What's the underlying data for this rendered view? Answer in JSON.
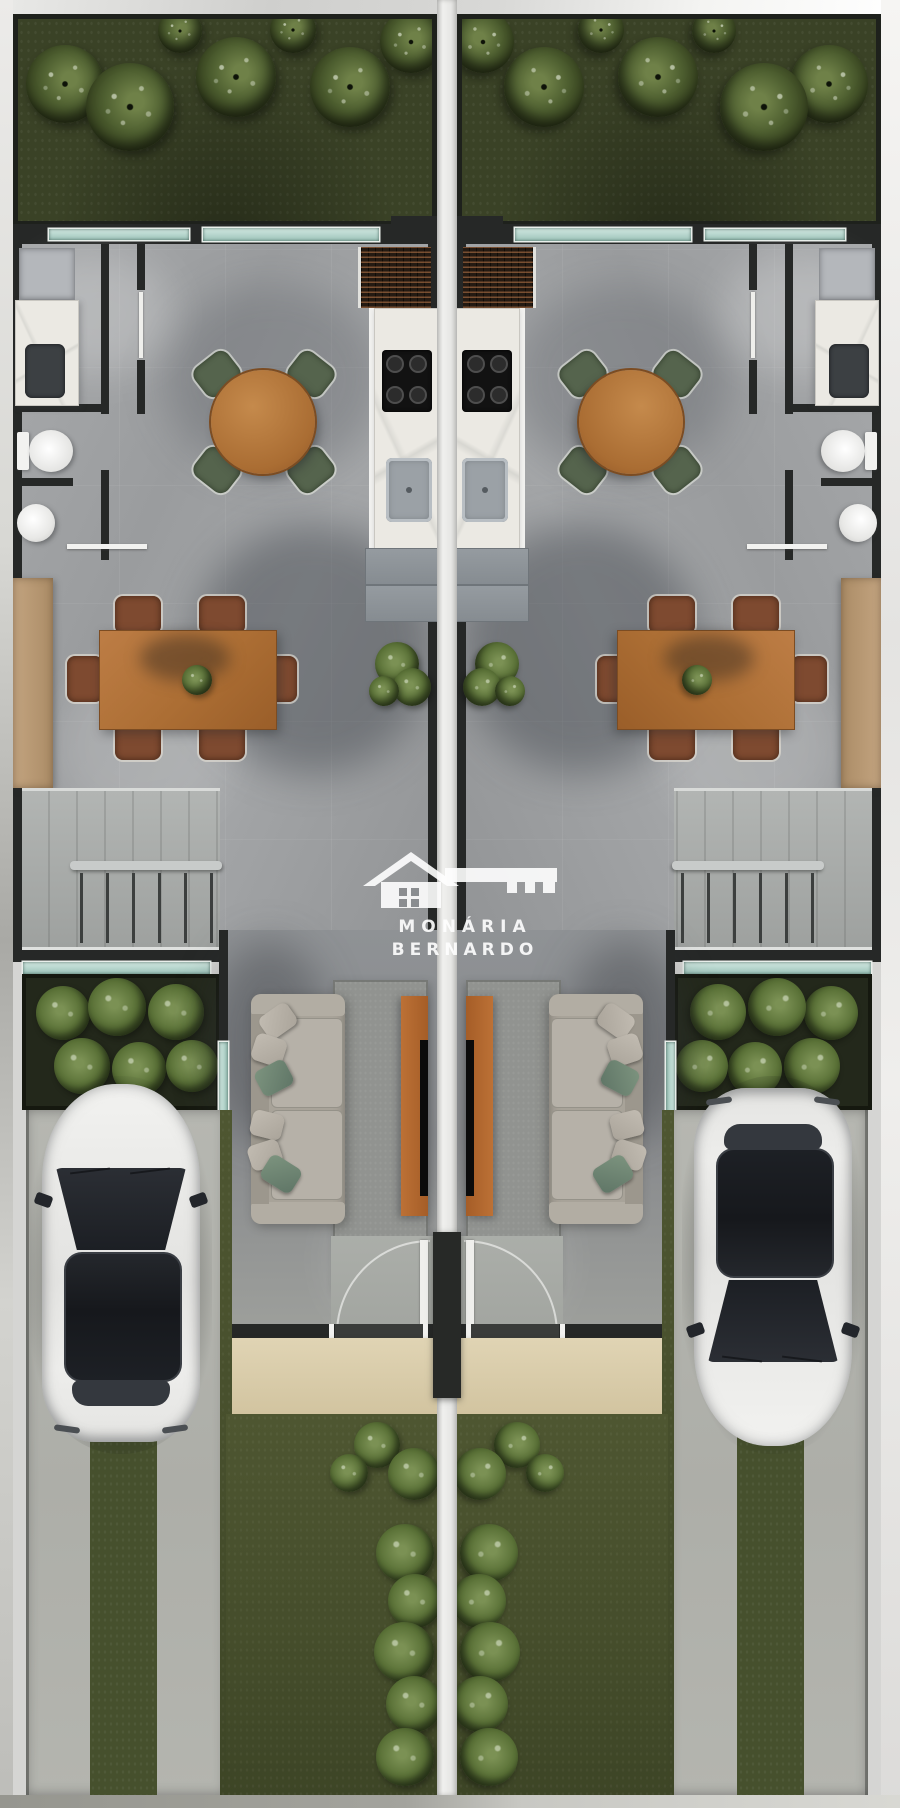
{
  "document": {
    "type": "architectural top-down floor plan render",
    "subject": "two mirrored townhouse units with gardens, driveways and parked cars"
  },
  "watermark": {
    "line1": "MONÁRIA",
    "line2": "BERNARDO",
    "logo": "house-with-key-icon",
    "color": "#ffffff"
  },
  "palette": {
    "backyard_lawn": "#3a4226",
    "front_lawn": "#4e5631",
    "floor_tile": "#9fa1a3",
    "wall": "#262827",
    "window_glass": "#9cc3b9",
    "marble_counter": "#ebe9e3",
    "wood_furniture": "#ac6e34",
    "dining_chair": "#7e4a30",
    "breakfast_chair": "#55644d",
    "sofa": "#a8a399",
    "pillow_green": "#6f8573",
    "rug": "#919390",
    "tv_console_wood": "#b0682f",
    "car_body": "#ececea",
    "car_glass": "#1c1f24",
    "driveway_concrete": "#b2b3ad",
    "entry_mat": "#d9cca9",
    "planting_soil": "#23281b",
    "stairs": "#a9aca9",
    "divider_gap": "#e6e6e4"
  }
}
